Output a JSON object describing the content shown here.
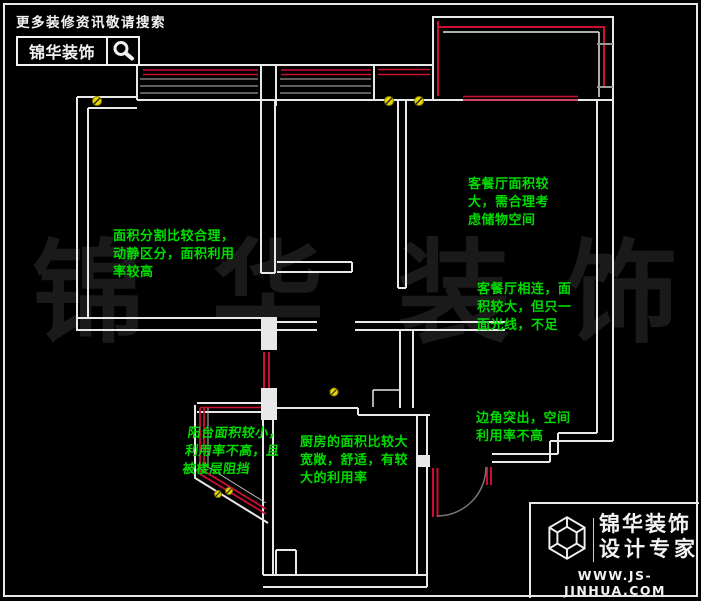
{
  "branding_top": {
    "tagline": "更多装修资讯敬请搜索",
    "brand": "锦华装饰",
    "search_icon": "magnifier"
  },
  "branding_bottom": {
    "brand_line1": "锦华装饰",
    "brand_line2": "设计专家",
    "website": "WWW.JS-JINHUA.COM",
    "logo_icon": "wireframe-cube"
  },
  "watermark": {
    "char1": "锦",
    "char2": "华",
    "char3": "装",
    "char4": "饰"
  },
  "annotations": {
    "bedroom_left": {
      "line1": "面积分割比较合理，",
      "line2": "动静区分，面积利用",
      "line3": "率较高"
    },
    "living_top": {
      "line1": "客餐厅面积较",
      "line2": "大，需合理考",
      "line3": "虑储物空间"
    },
    "living_mid": {
      "line1": "客餐厅相连，面",
      "line2": "积较大，但只一",
      "line3": "面光线，不足"
    },
    "corner": {
      "line1": "边角突出，空间",
      "line2": "利用率不高"
    },
    "balcony": {
      "line1": "阳台面积较小，",
      "line2": "利用率不高，且",
      "line3": "被楼层阻挡"
    },
    "kitchen": {
      "line1": "厨房的面积比较大",
      "line2": "宽敞，舒适，有较",
      "line3": "大的利用率"
    }
  },
  "colors": {
    "background": "#000000",
    "wall_white": "#e8e8e8",
    "window_red": "#cb0e32",
    "note_green": "#00dc00",
    "screw_yellow": "#e6d800",
    "watermark_gray": "#1a1a1a"
  }
}
